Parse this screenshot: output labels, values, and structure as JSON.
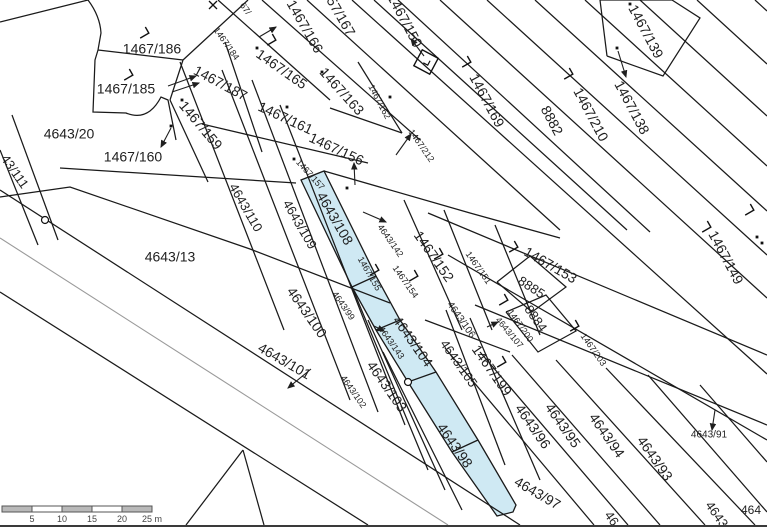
{
  "map": {
    "background": "#ffffff",
    "line_color": "#1a1a1a",
    "road_center_color": "#9a9a9a",
    "highlight_color": "#cfe9f3",
    "label_color": "#1f1f1f",
    "labels": [
      {
        "text": "1467/186",
        "x": 152,
        "y": 50,
        "angle": 0,
        "size": 14
      },
      {
        "text": "1467/185",
        "x": 126,
        "y": 90,
        "angle": 0,
        "size": 14
      },
      {
        "text": "1467/187",
        "x": 220,
        "y": 84,
        "angle": 28,
        "size": 14
      },
      {
        "text": "1467/184",
        "x": 226,
        "y": 44,
        "angle": 55,
        "size": 9
      },
      {
        "text": "1467/160",
        "x": 133,
        "y": 158,
        "angle": 0,
        "size": 14
      },
      {
        "text": "1467/159",
        "x": 200,
        "y": 126,
        "angle": 50,
        "size": 14
      },
      {
        "text": "4643/20",
        "x": 69,
        "y": 135,
        "angle": 0,
        "size": 14
      },
      {
        "text": "43/111",
        "x": 14,
        "y": 172,
        "angle": 55,
        "size": 13
      },
      {
        "text": "4643/13",
        "x": 170,
        "y": 258,
        "angle": 0,
        "size": 14
      },
      {
        "text": "67/",
        "x": 245,
        "y": 9,
        "angle": 55,
        "size": 9
      },
      {
        "text": "1467/166",
        "x": 304,
        "y": 27,
        "angle": 60,
        "size": 14
      },
      {
        "text": "57/167",
        "x": 340,
        "y": 17,
        "angle": 60,
        "size": 14
      },
      {
        "text": "1467/165",
        "x": 281,
        "y": 70,
        "angle": 35,
        "size": 14
      },
      {
        "text": "1467/163",
        "x": 341,
        "y": 92,
        "angle": 48,
        "size": 14
      },
      {
        "text": "1467/162",
        "x": 379,
        "y": 102,
        "angle": 62,
        "size": 9
      },
      {
        "text": "1467/161",
        "x": 285,
        "y": 119,
        "angle": 25,
        "size": 14
      },
      {
        "text": "1467/156",
        "x": 336,
        "y": 150,
        "angle": 25,
        "size": 14
      },
      {
        "text": "1467/157",
        "x": 310,
        "y": 175,
        "angle": 48,
        "size": 9
      },
      {
        "text": "1467/212",
        "x": 421,
        "y": 146,
        "angle": 55,
        "size": 9
      },
      {
        "text": "1467/150",
        "x": 404,
        "y": 21,
        "angle": 62,
        "size": 14
      },
      {
        "text": "1467/169",
        "x": 486,
        "y": 101,
        "angle": 62,
        "size": 14
      },
      {
        "text": "8882",
        "x": 551,
        "y": 121,
        "angle": 62,
        "size": 14
      },
      {
        "text": "1467/210",
        "x": 590,
        "y": 115,
        "angle": 62,
        "size": 14
      },
      {
        "text": "1467/138",
        "x": 631,
        "y": 108,
        "angle": 62,
        "size": 14
      },
      {
        "text": "1467/139",
        "x": 645,
        "y": 32,
        "angle": 62,
        "size": 14
      },
      {
        "text": "1467/149",
        "x": 725,
        "y": 258,
        "angle": 62,
        "size": 14
      },
      {
        "text": "1467/152",
        "x": 433,
        "y": 257,
        "angle": 55,
        "size": 14
      },
      {
        "text": "1467/151",
        "x": 478,
        "y": 268,
        "angle": 55,
        "size": 9
      },
      {
        "text": "1467/154",
        "x": 405,
        "y": 282,
        "angle": 55,
        "size": 9
      },
      {
        "text": "1467/153",
        "x": 550,
        "y": 266,
        "angle": 30,
        "size": 14
      },
      {
        "text": "8885",
        "x": 531,
        "y": 288,
        "angle": 33,
        "size": 13
      },
      {
        "text": "8884",
        "x": 535,
        "y": 319,
        "angle": 55,
        "size": 13
      },
      {
        "text": "1467/200",
        "x": 520,
        "y": 326,
        "angle": 55,
        "size": 9
      },
      {
        "text": "4643/107",
        "x": 509,
        "y": 333,
        "angle": 50,
        "size": 9
      },
      {
        "text": "1467/203",
        "x": 593,
        "y": 350,
        "angle": 55,
        "size": 9
      },
      {
        "text": "1467/199",
        "x": 491,
        "y": 371,
        "angle": 55,
        "size": 14
      },
      {
        "text": "4643/110",
        "x": 245,
        "y": 208,
        "angle": 60,
        "size": 13
      },
      {
        "text": "4643/109",
        "x": 299,
        "y": 225,
        "angle": 60,
        "size": 13
      },
      {
        "text": "4643/108",
        "x": 334,
        "y": 219,
        "angle": 60,
        "size": 14
      },
      {
        "text": "1467/155",
        "x": 369,
        "y": 274,
        "angle": 60,
        "size": 9
      },
      {
        "text": "4643/142",
        "x": 390,
        "y": 241,
        "angle": 55,
        "size": 9
      },
      {
        "text": "4643/100",
        "x": 306,
        "y": 313,
        "angle": 55,
        "size": 14
      },
      {
        "text": "4643/99",
        "x": 343,
        "y": 306,
        "angle": 55,
        "size": 9
      },
      {
        "text": "4643/101",
        "x": 284,
        "y": 362,
        "angle": 30,
        "size": 14
      },
      {
        "text": "4643/102",
        "x": 353,
        "y": 392,
        "angle": 55,
        "size": 9
      },
      {
        "text": "4643/103",
        "x": 386,
        "y": 387,
        "angle": 55,
        "size": 14
      },
      {
        "text": "4643/104",
        "x": 412,
        "y": 342,
        "angle": 55,
        "size": 14
      },
      {
        "text": "4643/143",
        "x": 391,
        "y": 343,
        "angle": 55,
        "size": 9
      },
      {
        "text": "4643/105",
        "x": 458,
        "y": 364,
        "angle": 55,
        "size": 13
      },
      {
        "text": "4643/106",
        "x": 461,
        "y": 320,
        "angle": 55,
        "size": 10
      },
      {
        "text": "4643/98",
        "x": 454,
        "y": 446,
        "angle": 55,
        "size": 14
      },
      {
        "text": "4643/97",
        "x": 537,
        "y": 494,
        "angle": 30,
        "size": 14
      },
      {
        "text": "4643/96",
        "x": 532,
        "y": 427,
        "angle": 55,
        "size": 14
      },
      {
        "text": "4643/95",
        "x": 562,
        "y": 426,
        "angle": 55,
        "size": 14
      },
      {
        "text": "4643/94",
        "x": 606,
        "y": 436,
        "angle": 55,
        "size": 14
      },
      {
        "text": "4643/93",
        "x": 654,
        "y": 459,
        "angle": 55,
        "size": 14
      },
      {
        "text": "4643/91",
        "x": 709,
        "y": 435,
        "angle": 0,
        "size": 10
      },
      {
        "text": "46",
        "x": 611,
        "y": 519,
        "angle": 55,
        "size": 13
      },
      {
        "text": "4643",
        "x": 716,
        "y": 515,
        "angle": 55,
        "size": 13
      },
      {
        "text": "464",
        "x": 751,
        "y": 511,
        "angle": 0,
        "size": 12
      }
    ],
    "lines": [
      [
        218,
        0,
        330,
        100
      ],
      [
        262,
        0,
        420,
        140
      ],
      [
        307,
        0,
        560,
        230
      ],
      [
        352,
        0,
        767,
        374
      ],
      [
        374,
        0,
        627,
        230
      ],
      [
        398,
        0,
        650,
        232
      ],
      [
        440,
        0,
        767,
        298
      ],
      [
        487,
        0,
        767,
        255
      ],
      [
        535,
        0,
        767,
        211
      ],
      [
        585,
        0,
        767,
        166
      ],
      [
        640,
        0,
        767,
        116
      ],
      [
        697,
        0,
        767,
        64
      ],
      [
        755,
        0,
        767,
        11
      ],
      [
        0,
        22,
        88,
        0
      ],
      [
        98,
        50,
        183,
        60
      ],
      [
        183,
        60,
        248,
        0
      ],
      [
        183,
        60,
        170,
        100
      ],
      [
        170,
        100,
        208,
        182
      ],
      [
        225,
        42,
        262,
        152
      ],
      [
        202,
        124,
        368,
        163
      ],
      [
        60,
        168,
        296,
        183
      ],
      [
        12,
        115,
        58,
        240
      ],
      [
        0,
        150,
        38,
        245
      ],
      [
        180,
        62,
        284,
        330
      ],
      [
        222,
        70,
        350,
        400
      ],
      [
        252,
        80,
        378,
        412
      ],
      [
        280,
        105,
        405,
        425
      ],
      [
        352,
        287,
        428,
        470
      ],
      [
        368,
        320,
        445,
        490
      ],
      [
        383,
        352,
        462,
        510
      ],
      [
        404,
        200,
        462,
        330
      ],
      [
        444,
        210,
        492,
        330
      ],
      [
        495,
        225,
        540,
        335
      ],
      [
        446,
        310,
        505,
        465
      ],
      [
        470,
        318,
        540,
        480
      ],
      [
        445,
        348,
        594,
        525
      ],
      [
        480,
        352,
        628,
        525
      ],
      [
        512,
        355,
        660,
        525
      ],
      [
        556,
        360,
        705,
        525
      ],
      [
        606,
        368,
        755,
        525
      ],
      [
        648,
        375,
        767,
        512
      ],
      [
        700,
        385,
        767,
        462
      ],
      [
        428,
        213,
        767,
        355
      ],
      [
        448,
        255,
        767,
        440
      ],
      [
        475,
        305,
        767,
        425
      ],
      [
        358,
        62,
        402,
        133
      ],
      [
        402,
        133,
        330,
        108
      ],
      [
        243,
        450,
        186,
        525
      ],
      [
        243,
        450,
        264,
        525
      ],
      [
        352,
        287,
        376,
        276
      ],
      [
        376,
        330,
        400,
        320
      ],
      [
        408,
        382,
        436,
        372
      ],
      [
        452,
        452,
        478,
        440
      ],
      [
        0,
        190,
        520,
        525
      ],
      [
        0,
        292,
        368,
        525
      ]
    ],
    "gray_lines": [
      [
        0,
        238,
        448,
        525
      ]
    ],
    "polylines": [
      [
        [
          0,
          197
        ],
        [
          70,
          187
        ],
        [
          250,
          249
        ],
        [
          390,
          303
        ]
      ],
      [
        [
          425,
          320
        ],
        [
          510,
          352
        ]
      ],
      [
        [
          324,
          171
        ],
        [
          470,
          213
        ],
        [
          560,
          238
        ]
      ],
      [
        [
          607,
          56
        ],
        [
          663,
          76
        ],
        [
          700,
          18
        ],
        [
          672,
          0
        ],
        [
          600,
          0
        ],
        [
          607,
          56
        ]
      ],
      [
        [
          497,
          282
        ],
        [
          530,
          256
        ],
        [
          566,
          287
        ],
        [
          532,
          312
        ],
        [
          497,
          282
        ]
      ],
      [
        [
          506,
          312
        ],
        [
          546,
          295
        ],
        [
          576,
          331
        ],
        [
          538,
          352
        ],
        [
          506,
          312
        ]
      ]
    ],
    "paths": [
      "M88,0 Q100,16 101,33 L98,50 L95,60 L93,112 L126,113 Q148,122 161,97 L168,100 L176,140"
    ],
    "blue_polygon": [
      [
        301,
        180
      ],
      [
        352,
        287
      ],
      [
        376,
        330
      ],
      [
        408,
        382
      ],
      [
        452,
        452
      ],
      [
        497,
        516
      ],
      [
        513,
        512
      ],
      [
        516,
        505
      ],
      [
        478,
        440
      ],
      [
        436,
        372
      ],
      [
        400,
        320
      ],
      [
        376,
        276
      ],
      [
        324,
        171
      ]
    ],
    "dots": [
      [
        257,
        48
      ],
      [
        287,
        107
      ],
      [
        322,
        72
      ],
      [
        390,
        97
      ],
      [
        347,
        188
      ],
      [
        294,
        159
      ],
      [
        182,
        100
      ],
      [
        171,
        126
      ],
      [
        630,
        4
      ],
      [
        617,
        48
      ],
      [
        757,
        237
      ],
      [
        762,
        243
      ]
    ],
    "circles": [
      [
        45,
        220
      ],
      [
        408,
        382
      ]
    ],
    "corner_marks": [
      [
        143,
        33
      ],
      [
        127,
        75
      ],
      [
        270,
        40
      ],
      [
        465,
        62
      ],
      [
        567,
        74
      ],
      [
        512,
        247
      ],
      [
        705,
        227
      ],
      [
        748,
        210
      ],
      [
        437,
        254
      ],
      [
        412,
        276
      ],
      [
        373,
        270
      ],
      [
        502,
        300
      ],
      [
        573,
        326
      ],
      [
        500,
        362
      ]
    ],
    "arrows": [
      [
        168,
        86,
        196,
        76
      ],
      [
        172,
        92,
        199,
        83
      ],
      [
        171,
        128,
        161,
        147
      ],
      [
        424,
        56,
        411,
        39
      ],
      [
        618,
        51,
        626,
        77
      ],
      [
        355,
        185,
        354,
        163
      ],
      [
        396,
        155,
        411,
        134
      ],
      [
        363,
        212,
        386,
        222
      ],
      [
        374,
        326,
        384,
        331
      ],
      [
        487,
        327,
        498,
        322
      ],
      [
        311,
        369,
        288,
        388
      ],
      [
        715,
        410,
        712,
        430
      ],
      [
        259,
        37,
        276,
        27
      ]
    ],
    "x_marks": [
      [
        213,
        5
      ]
    ],
    "diamond_symbol": {
      "x": 426,
      "y": 62,
      "r": 9,
      "angle": 28
    },
    "scale_bar": {
      "x": 2,
      "y": 506,
      "height": 6,
      "segment_px": 30,
      "segments": 5,
      "fill_dark": "#b9b9b9",
      "fill_light": "#ffffff",
      "border": "#555555",
      "tick_labels": [
        "5",
        "10",
        "15",
        "20",
        "25 m"
      ]
    }
  }
}
